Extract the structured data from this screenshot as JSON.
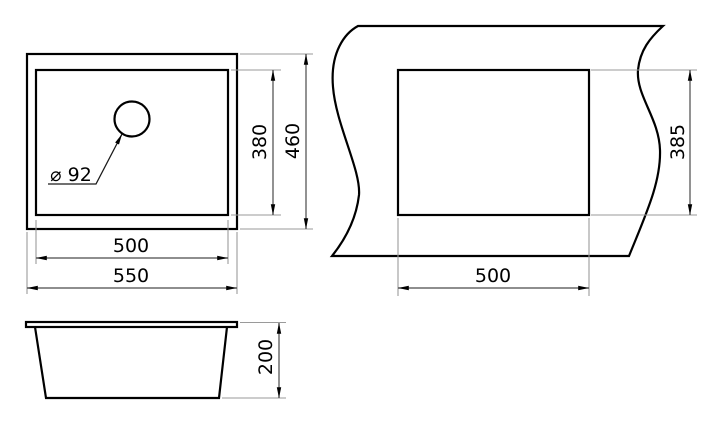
{
  "drawing": {
    "kind": "sink technical drawing, three orthographic views",
    "colors": {
      "background": "#ffffff",
      "outline": "#000000",
      "dimension_line": "#4a4a4a",
      "extension_line": "#9a9a9a"
    },
    "views": {
      "top_view": {
        "label": "sink plan view",
        "dims": {
          "inner_height": "380",
          "outer_height": "460",
          "inner_width": "500",
          "outer_width": "550",
          "drain_diameter": "⌀ 92"
        }
      },
      "cutout_view": {
        "label": "countertop cutout view",
        "dims": {
          "height": "385",
          "width": "500"
        }
      },
      "side_view": {
        "label": "sink side elevation",
        "dims": {
          "height": "200"
        }
      }
    }
  }
}
